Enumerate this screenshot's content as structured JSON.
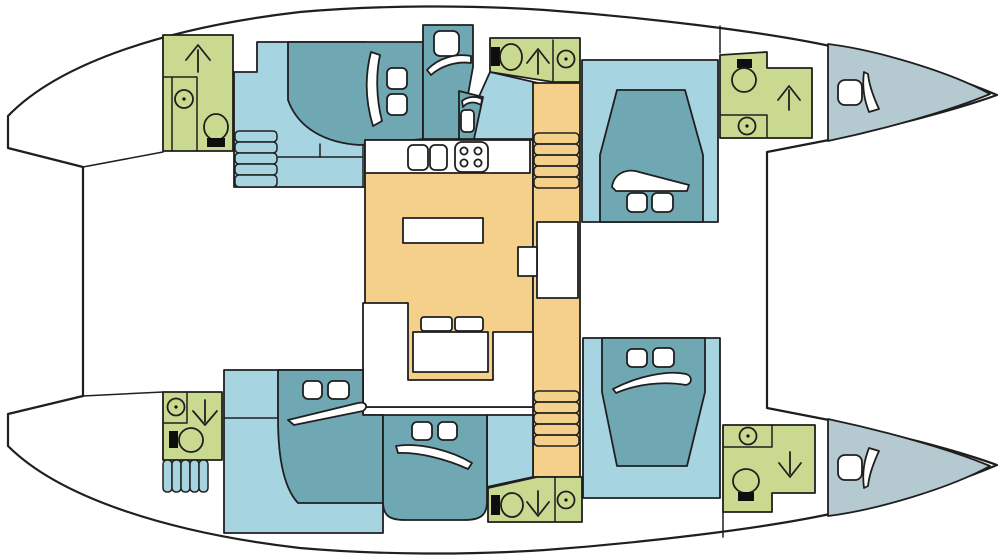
{
  "diagram": {
    "type": "floorplan",
    "subject": "catamaran yacht lower-deck layout plan",
    "orientation": "bow-right",
    "hulls": 2
  },
  "colors": {
    "outline": "#1f1f1f",
    "deck": "#ffffff",
    "cabin_floor": "#a7d4e1",
    "bed": "#6fa8b3",
    "bathroom": "#c9da90",
    "salon": "#f4d08b",
    "bow_locker": "#b4cad0",
    "fixture": "#ffffff",
    "ink": "#0e0e0e"
  },
  "rooms": {
    "port_hull": [
      {
        "id": "bathroom-port-aft",
        "type": "bathroom",
        "fixtures": [
          "toilet",
          "sink",
          "shower-arrow-up"
        ]
      },
      {
        "id": "cabin-port-aft",
        "type": "cabin",
        "fixtures": [
          "double-bed",
          "pillow",
          "hatch",
          "hatch",
          "steps"
        ]
      },
      {
        "id": "cabin-port-mid",
        "type": "cabin",
        "fixtures": [
          "bed",
          "pillow",
          "hatch",
          "berth",
          "pillow",
          "hatch"
        ]
      },
      {
        "id": "bathroom-port-mid",
        "type": "bathroom",
        "fixtures": [
          "toilet",
          "shower-arrow-up",
          "sink"
        ]
      },
      {
        "id": "cabin-port-fwd",
        "type": "cabin",
        "fixtures": [
          "island-bed",
          "pillow",
          "hatch",
          "hatch"
        ]
      },
      {
        "id": "bathroom-port-fwd",
        "type": "bathroom",
        "fixtures": [
          "toilet",
          "shower-arrow-up",
          "sink"
        ]
      },
      {
        "id": "bow-locker-port",
        "type": "forepeak",
        "fixtures": [
          "hatch",
          "pillow"
        ]
      }
    ],
    "starboard_hull": [
      {
        "id": "bathroom-stbd-aft",
        "type": "bathroom",
        "fixtures": [
          "sink",
          "shower-arrow-down",
          "toilet"
        ]
      },
      {
        "id": "cabin-stbd-aft",
        "type": "cabin",
        "fixtures": [
          "double-bed",
          "pillow",
          "hatch",
          "hatch",
          "steps"
        ]
      },
      {
        "id": "cabin-stbd-mid",
        "type": "cabin",
        "fixtures": [
          "bed",
          "pillow",
          "hatch",
          "hatch"
        ]
      },
      {
        "id": "bathroom-stbd-mid",
        "type": "bathroom",
        "fixtures": [
          "toilet",
          "shower-arrow-down",
          "sink"
        ]
      },
      {
        "id": "cabin-stbd-fwd",
        "type": "cabin",
        "fixtures": [
          "island-bed",
          "pillow",
          "hatch",
          "hatch"
        ]
      },
      {
        "id": "bathroom-stbd-fwd",
        "type": "bathroom",
        "fixtures": [
          "sink",
          "shower-arrow-down",
          "toilet"
        ]
      },
      {
        "id": "bow-locker-stbd",
        "type": "forepeak",
        "fixtures": [
          "hatch",
          "pillow"
        ]
      }
    ],
    "salon": {
      "id": "salon",
      "galley": {
        "sinks": 2,
        "stove_burners": 4
      },
      "island_table": 1,
      "nav_seat": 1,
      "sofa": {
        "shape": "U",
        "cushions": 2,
        "table": 1
      },
      "stairs": [
        {
          "id": "stairs-to-port-hull",
          "treads": 5
        },
        {
          "id": "stairs-to-stbd-hull",
          "treads": 5
        }
      ]
    },
    "hull_stairs": [
      {
        "id": "steps-port-aft",
        "treads": 5
      },
      {
        "id": "steps-stbd-aft",
        "treads": 5
      }
    ],
    "decks": [
      "aft-cockpit",
      "foredeck",
      "trampoline-area"
    ]
  }
}
